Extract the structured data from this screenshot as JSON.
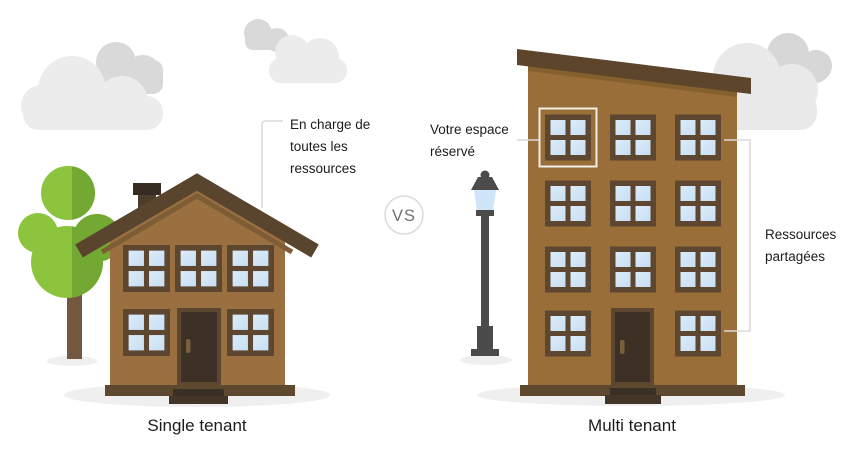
{
  "scene": {
    "left": {
      "label": "Single tenant",
      "annotation": [
        "En charge de",
        "toutes les",
        "ressources"
      ]
    },
    "versus": {
      "label": "VS"
    },
    "right": {
      "label": "Multi tenant",
      "reserved_annotation": [
        "Votre espace",
        "réservé"
      ],
      "shared_annotation": [
        "Ressources",
        "partagées"
      ]
    }
  },
  "colors": {
    "house_body_left": "#9b7040",
    "house_body_right": "#9a6e38",
    "roof_left": "#59442e",
    "roof_right": "#5c452b",
    "roof_trim": "#7d5c36",
    "window_frame": "#5d4731",
    "window_pane": "#cde4f6",
    "door": "#3d3126",
    "door_frame": "#5d4731",
    "door_handle": "#7a5f3e",
    "base_platform": "#5f4830",
    "steps": "#3b3026",
    "chimney_cap": "#362b20",
    "chimney_stem": "#4c3c2b",
    "tree_light": "#8cc43d",
    "tree_dark": "#73a833",
    "trunk": "#73573e",
    "lamp": "#4b4b4b",
    "lamp_glass": "#cfe6fa",
    "cloud_light": "#ececec",
    "cloud_dark": "#d9d9d9",
    "ground_shadow": "#efefef",
    "annotation_line": "#d9d9d9",
    "highlight_box": "#f3efe8",
    "vs_circle_stroke": "#dcdcdc",
    "vs_text": "#707070",
    "text": "#1c1c1c"
  }
}
